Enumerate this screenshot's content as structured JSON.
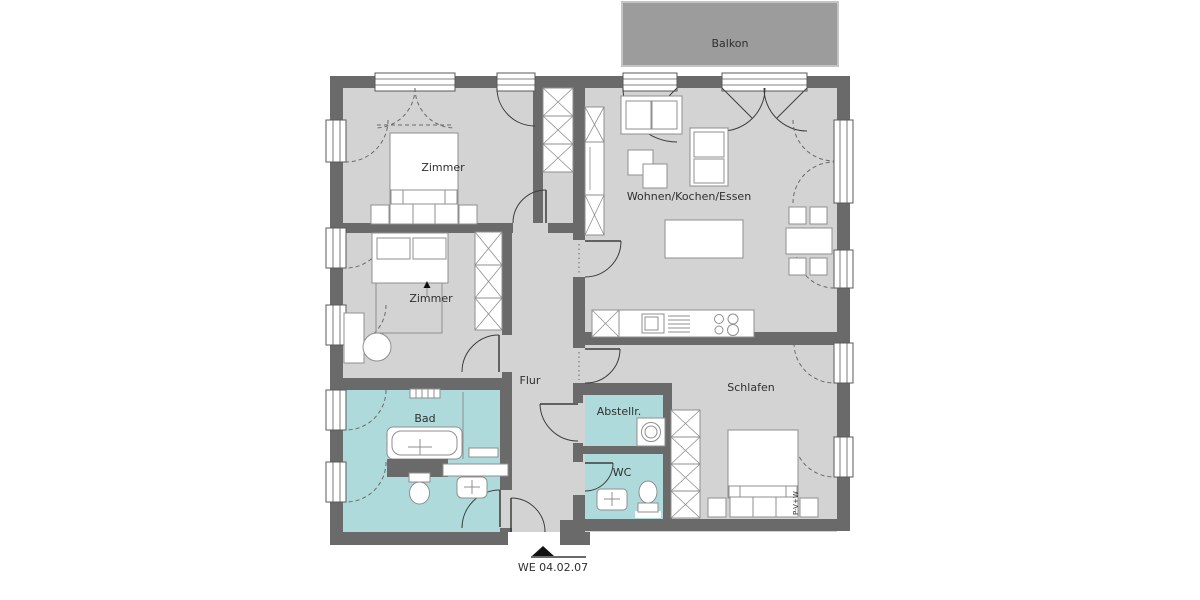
{
  "plan": {
    "unit_label": "WE 04.02.07",
    "rooms": {
      "balkon": "Balkon",
      "zimmer1": "Zimmer",
      "zimmer2": "Zimmer",
      "wohnen": "Wohnen/Kochen/Essen",
      "flur": "Flur",
      "schlafen": "Schlafen",
      "bad": "Bad",
      "abstellraum": "Abstellr.",
      "wc": "WC"
    },
    "bed_annotation": "P-V+W"
  },
  "colors": {
    "wall": "#6a6a6a",
    "floor": "#d3d3d3",
    "wet_room": "#aedadb",
    "balcony": "#9c9c9c",
    "line": "#3c3c3c",
    "text": "#2f2f2f",
    "furniture_fill": "#ffffff"
  }
}
